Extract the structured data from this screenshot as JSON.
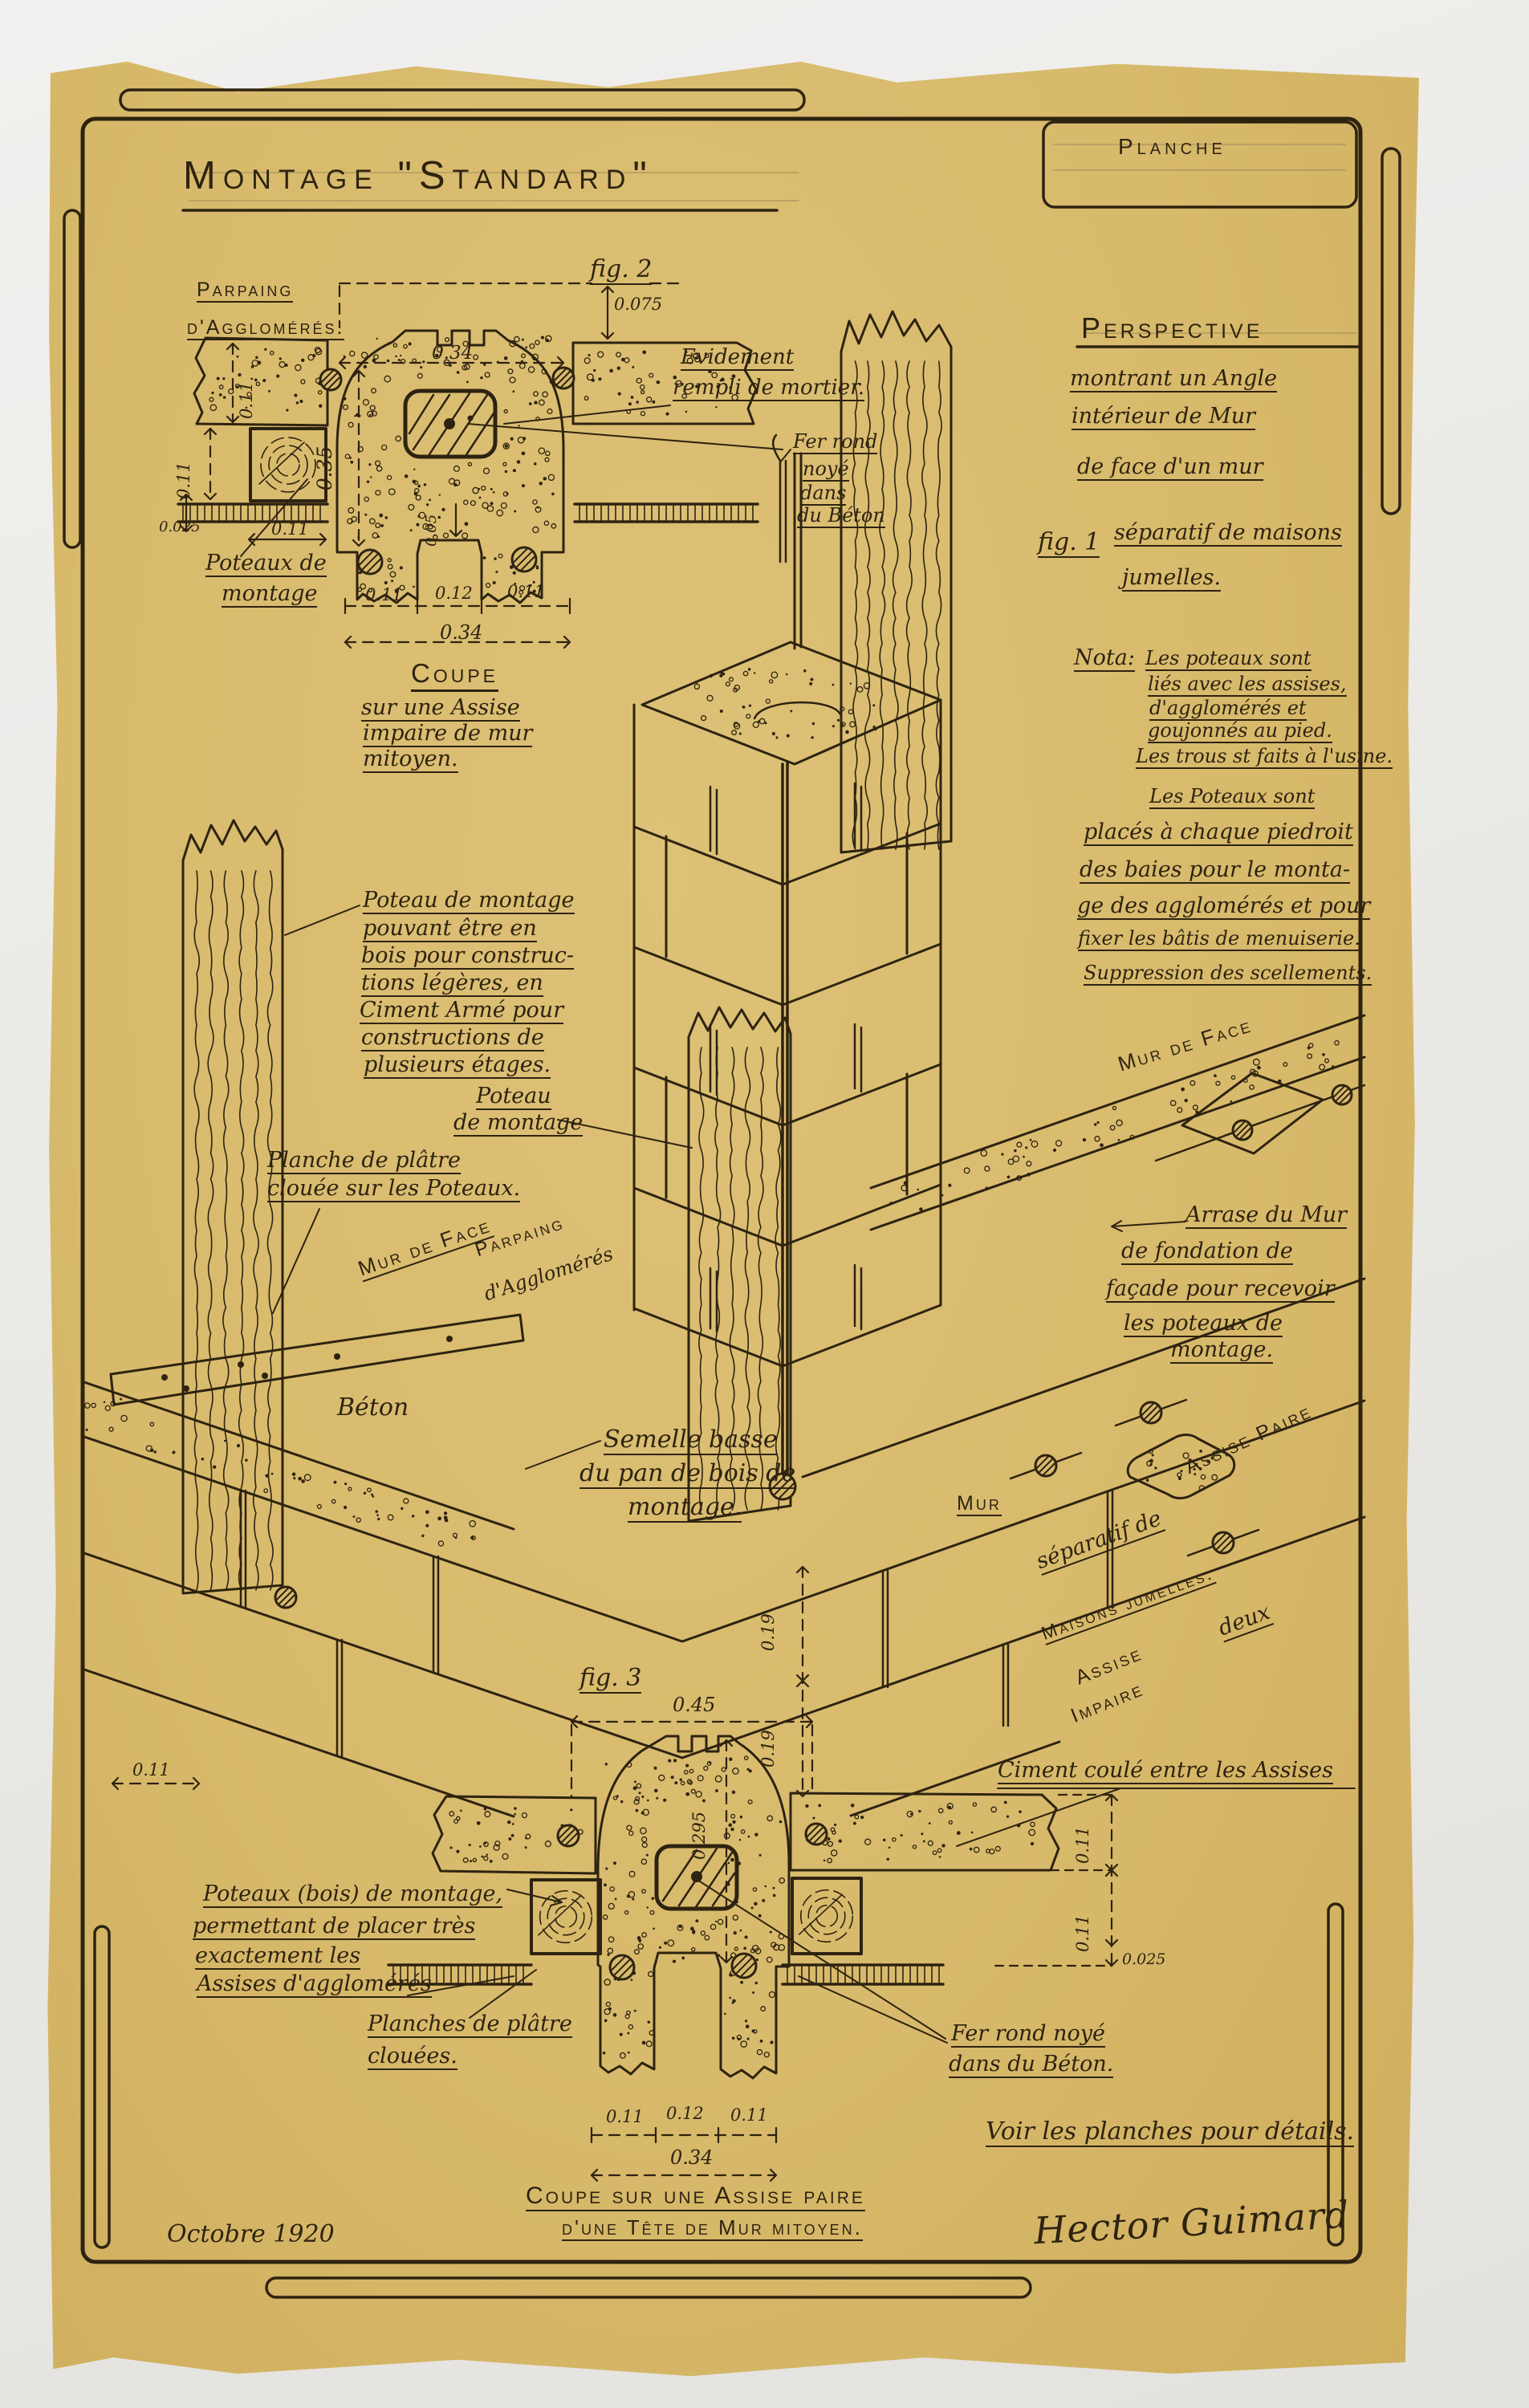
{
  "page": {
    "background": "#ecebe7",
    "paper_color": "#d8ba6c",
    "ink": "#2e2310"
  },
  "header": {
    "title": "Montage \"Standard\"",
    "plate_box_label": "Planche"
  },
  "fig1": {
    "title": "Perspective",
    "subtitle_lines": [
      "montrant un Angle",
      "intérieur de Mur",
      "de face d'un mur",
      "séparatif de maisons",
      "jumelles."
    ],
    "fig_label": "fig. 1",
    "nota_label": "Nota:",
    "nota_lines": [
      "Les poteaux sont",
      "liés avec les assises,",
      "d'agglomérés et",
      "goujonnés au pied.",
      "Les trous st faits à l'usine."
    ],
    "nota_lines_2": [
      "Les Poteaux sont",
      "placés à chaque piedroit",
      "des baies pour le monta-",
      "ge des agglomérés et pour",
      "fixer les bâtis de menuiserie.",
      "Suppression des scellements."
    ]
  },
  "fig2": {
    "fig_label": "fig. 2",
    "caption_title": "Coupe",
    "caption_lines": [
      "sur une Assise",
      "impaire de mur",
      "mitoyen."
    ],
    "labels": {
      "parpaing_line1": "Parpaing",
      "parpaing_line2": "d'Agglomérés.",
      "evidement_line1": "Evidement",
      "evidement_line2": "rempli de mortier.",
      "fer_rond_lines": [
        "Fer rond",
        "noyé",
        "dans",
        "du Béton"
      ],
      "poteaux_line1": "Poteaux de",
      "poteaux_line2": "montage"
    },
    "dims": {
      "d075": "0.075",
      "d34_top": "0.34",
      "d35": "0.35",
      "d11_left": "0.11",
      "d11_left2": "0.11",
      "d025": "0.025",
      "d11_post": "0.11",
      "d05": "0.05",
      "d11_a": "0.11",
      "d12": "0.12",
      "d11_b": "0.11",
      "d34_bottom": "0.34"
    }
  },
  "perspective_labels": {
    "poteau_note_lines": [
      "Poteau de montage",
      "pouvant être en",
      "bois pour construc-",
      "tions légères, en",
      "Ciment Armé pour",
      "constructions de",
      "plusieurs étages."
    ],
    "poteau2_line1": "Poteau",
    "poteau2_line2": "de montage",
    "planche_platre_line1": "Planche de plâtre",
    "planche_platre_line2": "clouée sur les Poteaux.",
    "mur_de_face_left": "Mur de Face",
    "parpaing_line1": "Parpaing",
    "parpaing_line2": "d'Agglomérés",
    "beton": "Béton",
    "semelle_lines": [
      "Semelle basse",
      "du pan de bois de",
      "montage."
    ],
    "mur_de_face_right": "Mur de Face",
    "arrase_lines": [
      "Arrase du Mur",
      "de fondation de",
      "façade pour recevoir",
      "les poteaux de",
      "montage."
    ],
    "assise_paire": "Assise Paire",
    "mur_sep_1": "Mur",
    "mur_sep_2": "séparatif de",
    "mur_sep_3": "deux",
    "mur_sep_4": "Maisons jumelles.",
    "assise_impaire_1": "Assise",
    "assise_impaire_2": "Impaire",
    "dims": {
      "d19_a": "0.19",
      "d19_b": "0.19",
      "d11": "0.11"
    }
  },
  "fig3": {
    "fig_label": "fig. 3",
    "ciment": "Ciment coulé entre les Assises",
    "poteaux_note_lines": [
      "Poteaux (bois) de montage,",
      "permettant de placer très",
      "exactement les",
      "Assises d'agglomérés"
    ],
    "planches_line1": "Planches de plâtre",
    "planches_line2": "clouées.",
    "fer_rond_line1": "Fer rond noyé",
    "fer_rond_line2": "dans du Béton.",
    "caption_line1": "Coupe sur une Assise paire",
    "caption_line2": "d'une Tête de Mur mitoyen.",
    "dims": {
      "d45": "0.45",
      "d295": "0.295",
      "d11_r1": "0.11",
      "d11_r2": "0.11",
      "d025": "0.025",
      "d11_a": "0.11",
      "d12": "0.12",
      "d11_b": "0.11",
      "d34": "0.34"
    }
  },
  "footer": {
    "date": "Octobre 1920",
    "note": "Voir les planches pour détails.",
    "signature": "Hector Guimard"
  }
}
